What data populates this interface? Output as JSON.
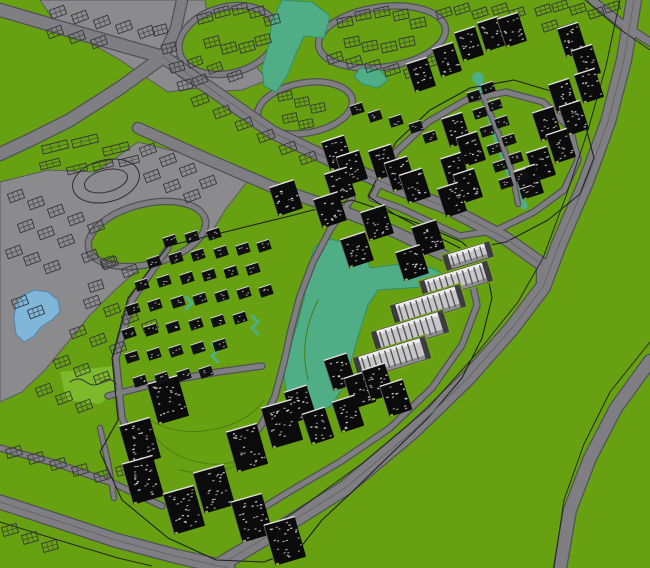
{
  "canvas": {
    "width": 650,
    "height": 568
  },
  "palette": {
    "grass": "#67a112",
    "grass_light": "#7cb92b",
    "paved": "#8b8b8e",
    "road": "#7f7f83",
    "road_casing": "#525256",
    "road_centerline": "#66666a",
    "outline_dark": "#1f1f22",
    "wireframe": "#35353a",
    "water_lake": "#4fae85",
    "water_lake_edge": "#2e8e67",
    "water_pond": "#7fb6d9",
    "water_pond_edge": "#4e86ad",
    "building_dark": "#0b0b0b",
    "building_window": "#d8d8d8",
    "building_cap": "#e0e0e0",
    "slab_body": "#c7c7c9",
    "slab_stripe": "#55555a",
    "slab_top": "#ececec",
    "slab_end": "#3d3d40",
    "landscape_line": "#4c7c10"
  },
  "scene": {
    "areas": [
      {
        "name": "paved-northwest-corridor",
        "pts": "40,0 205,0 212,45 198,88 168,92 120,60 55,22"
      },
      {
        "name": "paved-north-center-patch",
        "pts": "168,56 250,60 268,80 242,90 205,92 178,76"
      },
      {
        "name": "paved-west-district",
        "pts": "0,182 48,170 96,172 138,142 178,152 218,164 250,178 225,210 210,235 168,248 140,268 115,290 90,315 68,342 45,370 22,392 0,402"
      }
    ],
    "patches": [
      {
        "name": "park-lawn-patch",
        "pts": "60,372 112,366 120,390 100,404 66,400"
      }
    ],
    "rings": [
      {
        "name": "loop-road-a",
        "cx": 228,
        "cy": 40,
        "rx": 50,
        "ry": 33,
        "rot": -15,
        "w": 5
      },
      {
        "name": "loop-road-b",
        "cx": 382,
        "cy": 37,
        "rx": 64,
        "ry": 30,
        "rot": -8,
        "w": 5
      },
      {
        "name": "loop-road-c",
        "cx": 305,
        "cy": 108,
        "rx": 48,
        "ry": 25,
        "rot": -10,
        "w": 5
      },
      {
        "name": "loop-road-d",
        "cx": 147,
        "cy": 234,
        "rx": 60,
        "ry": 30,
        "rot": -14,
        "w": 5
      }
    ],
    "water": [
      {
        "name": "west-pond",
        "kind": "pond",
        "pts": "22,296 34,290 48,292 58,300 60,312 52,320 42,326 34,336 24,342 16,334 14,318 16,304"
      },
      {
        "name": "north-pond",
        "kind": "lake",
        "pts": "282,0 312,2 330,16 324,38 304,36 295,56 287,76 276,92 264,86 262,68 269,44 272,20"
      },
      {
        "name": "north-pond-east",
        "kind": "lake",
        "pts": "360,68 380,70 388,80 378,88 362,84 354,76"
      },
      {
        "name": "central-lake",
        "kind": "lake",
        "pts": "325,238 352,244 366,256 370,268 402,264 432,268 447,276 436,286 408,288 378,290 368,305 360,330 352,358 344,385 332,405 315,416 297,410 286,395 284,372 290,348 298,322 305,295 308,268 314,248"
      },
      {
        "name": "northeast-stream",
        "kind": "stream",
        "w": 7,
        "pts": "479,82 486,102 492,122 498,142 505,160 511,177 518,194 524,206"
      },
      {
        "name": "villa-brook-1",
        "kind": "stream",
        "w": 3,
        "pts": "252,316 258,322 252,328 258,334"
      },
      {
        "name": "villa-brook-2",
        "kind": "stream",
        "w": 3,
        "pts": "212,344 218,350 212,356 218,362"
      },
      {
        "name": "villa-brook-3",
        "kind": "stream",
        "w": 3,
        "pts": "186,297 192,303 186,309"
      }
    ],
    "roads": [
      {
        "name": "loop-road-ne-district",
        "w": 5,
        "pts": "372,198 396,152 428,122 466,100 506,92 543,102 570,128 578,160 564,190 534,212 497,230 460,236 430,222 400,208 372,198"
      },
      {
        "name": "ne-district-spine",
        "w": 4,
        "pts": "484,98 498,132 512,172 518,204"
      },
      {
        "name": "villas-west-road",
        "w": 5,
        "pts": "168,248 132,300 116,358 122,418 140,462"
      },
      {
        "name": "lakeshore-road",
        "w": 5,
        "pts": "352,198 330,230 313,262 300,296 291,330 284,362 275,396 262,424 247,444"
      },
      {
        "name": "villas-south-road",
        "w": 5,
        "pts": "108,396 162,382 218,372 262,366"
      },
      {
        "name": "slabs-service-road",
        "w": 5,
        "pts": "470,272 477,305 462,345 432,388 390,428 340,462 292,490 256,512"
      },
      {
        "name": "southwest-minor-road",
        "w": 5,
        "pts": "0,448 58,464 115,484 162,506"
      },
      {
        "name": "southwest-link-road",
        "w": 4,
        "pts": "100,428 108,462 114,498"
      },
      {
        "name": "corner-road-ne",
        "w": 7,
        "pts": "592,0 622,24 650,42"
      },
      {
        "name": "arterial-nw-west",
        "w": 12,
        "pts": "0,10 55,26 110,42 163,57"
      },
      {
        "name": "arterial-nw-north",
        "w": 10,
        "pts": "163,57 176,28 182,0"
      },
      {
        "name": "arterial-sw-branch",
        "w": 12,
        "pts": "163,57 120,88 70,120 30,140 0,154"
      },
      {
        "name": "central-boulevard-north",
        "w": 12,
        "pts": "163,57 215,92 272,132 335,162 392,186 448,208 505,238 543,265 543,287"
      },
      {
        "name": "central-boulevard-south",
        "w": 10,
        "pts": "138,128 205,158 270,186 335,208 395,232 445,256 468,272"
      },
      {
        "name": "ring-expressway",
        "w": 14,
        "pts": "634,0 624,60 608,122 586,182 560,242 543,287 512,328 468,378 412,432 345,488 275,532 228,560 215,568"
      },
      {
        "name": "southeast-curve-road",
        "w": 12,
        "pts": "650,361 616,408 590,458 570,510 560,568"
      },
      {
        "name": "southwest-arc-road",
        "w": 13,
        "pts": "0,502 55,520 115,540 175,556 228,568"
      }
    ],
    "strokes": [
      {
        "name": "parcel-outline-central",
        "color": "#1f1f22",
        "w": 1.1,
        "close": true,
        "pts": "352,200 290,216 225,232 168,246 128,298 112,358 118,420 100,452 122,500 168,538 216,560 264,562 300,548 322,520 352,492 390,455 428,418 462,378 482,338 492,298 486,266 462,242 425,226 388,212"
      },
      {
        "name": "parcel-outline-northeast",
        "color": "#1f1f22",
        "w": 1.1,
        "close": true,
        "pts": "368,196 396,142 430,110 470,88 514,80 554,92 584,120 594,158 580,194 548,220 506,242 464,250 428,232 394,214"
      },
      {
        "name": "boundary-line-expressway",
        "color": "#26262a",
        "w": 1,
        "pts": "620,0 606,66 588,130 566,196 543,258 518,302 478,352 428,408 364,462 298,510 252,540"
      },
      {
        "name": "boundary-line-se-curve",
        "color": "#26262a",
        "w": 1,
        "pts": "650,342 610,392 584,444 564,500 554,568"
      },
      {
        "name": "boundary-line-ne-corner",
        "color": "#26262a",
        "w": 1,
        "pts": "585,0 618,28 650,50"
      },
      {
        "name": "boundary-line-sw-arc",
        "color": "#26262a",
        "w": 1,
        "pts": "0,522 58,540 118,558 152,566"
      },
      {
        "name": "centerline-expressway",
        "color": "#66666a",
        "w": 1,
        "pts": "634,0 624,60 608,122 586,182 560,242 543,287 512,328 468,378 412,432 345,488 275,532 228,560"
      },
      {
        "name": "centerline-boulevard",
        "color": "#66666a",
        "w": 1,
        "pts": "163,57 215,92 272,132 335,162 392,186 448,208 505,238 543,265"
      },
      {
        "name": "centerline-sw-arc",
        "color": "#66666a",
        "w": 1,
        "pts": "0,502 55,520 115,540 175,556 228,568"
      },
      {
        "name": "stadium-track-outer",
        "color": "#2f2f33",
        "w": 1,
        "ellipse": [
          106,
          181,
          34,
          21,
          -14
        ]
      },
      {
        "name": "stadium-track-inner",
        "color": "#2f2f33",
        "w": 1,
        "ellipse": [
          106,
          181,
          22,
          11,
          -14
        ]
      },
      {
        "name": "park-path-squiggle",
        "color": "#2f2f33",
        "w": 1,
        "d": "M 70,382 q 8,-6 16,0 q 8,6 16,0 q 8,-6 14,2"
      },
      {
        "name": "landscape-curve-1",
        "color": "#4c7c10",
        "w": 1,
        "d": "M 150,420 q 30,18 70,8 q 30,-8 44,-28"
      },
      {
        "name": "landscape-curve-2",
        "color": "#4c7c10",
        "w": 1,
        "d": "M 180,470 q 40,10 70,-14"
      },
      {
        "name": "landscape-curve-3",
        "color": "#4c7c10",
        "w": 1,
        "d": "M 318,300 q -20,40 -10,80"
      },
      {
        "name": "landscape-curve-4",
        "color": "#4c7c10",
        "w": 1,
        "d": "M 150,430 q 20,30 60,34 q 30,2 50,-16"
      }
    ],
    "buildings": {
      "towers": [
        {
          "name": "towers-northeast",
          "w": 22,
          "h": 30,
          "rot": -18,
          "items": "421,75 447,60 469,44 492,34 512,30 572,40 586,62 589,86 563,96 574,118 547,124 561,146 541,164 529,182 456,130 471,149 455,170 468,186 452,200"
        },
        {
          "name": "towers-midblock",
          "w": 24,
          "h": 30,
          "rot": -18,
          "items": "337,153 352,168 340,185 384,162 400,174 415,186"
        },
        {
          "name": "towers-central-north",
          "w": 26,
          "h": 30,
          "rot": -18,
          "items": "286,198 330,210 377,223 428,238 357,250 412,263"
        },
        {
          "name": "towers-lake-south",
          "w": 24,
          "h": 32,
          "rot": -18,
          "items": "340,372 360,390 348,414 300,404 318,426 378,382 396,398"
        },
        {
          "name": "towers-southwest",
          "w": 32,
          "h": 42,
          "rot": -16,
          "items": "168,400 140,442 143,480 184,510 214,489 247,448 282,424 252,518 285,541"
        }
      ],
      "villas": [
        {
          "name": "villas-central-grid",
          "w": 13,
          "h": 10,
          "rot": -18,
          "items": "170,241 192,237 214,234 154,262 176,258 198,255 221,252 243,249 264,246 142,285 164,281 187,278 209,275 231,272 253,269 133,309 155,305 178,302 200,299 222,296 244,293 266,291 129,333 151,330 173,327 196,324 218,321 240,318 132,357 154,354 176,351 198,348 220,345 140,381 162,378 184,375 206,372"
        },
        {
          "name": "villas-ne-stream-rows",
          "w": 13,
          "h": 10,
          "rot": -18,
          "items": "488,88 495,105 502,122 509,140 516,158 521,175 527,192 474,96 480,113 487,131 494,149 500,166 506,183 357,109 375,116 396,121 416,127 430,137"
        }
      ],
      "slabs": {
        "name": "slab-blocks-lakeside",
        "rot": -17,
        "items": "456,281,70,20 428,306,72,22 410,332,74,22 392,358,74,22 468,256,48,15"
      },
      "wires": [
        {
          "name": "wireframe-nw-corridor",
          "w": 15,
          "h": 9,
          "rot": -20,
          "items": "58,12 80,17 102,22 124,27 146,32 55,32 77,37 99,42"
        },
        {
          "name": "wireframe-loop-a",
          "w": 15,
          "h": 9,
          "rot": -15,
          "items": "205,18 222,12 240,9 257,12 272,20 212,42 229,48 247,47 263,40"
        },
        {
          "name": "wireframe-west-of-a",
          "w": 14,
          "h": 9,
          "rot": -15,
          "items": "160,30 169,48 177,67 185,85"
        },
        {
          "name": "wireframe-loop-b",
          "w": 15,
          "h": 9,
          "rot": -12,
          "items": "345,22 363,15 382,12 401,15 418,23 352,42 370,46 389,47 407,42"
        },
        {
          "name": "wireframe-north-rows",
          "w": 15,
          "h": 8,
          "rot": -18,
          "items": "444,13 462,9 480,13 500,9 517,13 543,10 560,6 578,9 596,13 612,7 550,26 568,29"
        },
        {
          "name": "wireframe-below-b",
          "w": 15,
          "h": 9,
          "rot": -18,
          "items": "335,58 354,62 373,66 392,70 412,72 430,62 448,56"
        },
        {
          "name": "wireframe-north-patch",
          "w": 14,
          "h": 8,
          "rot": -20,
          "items": "195,62 215,68 235,76 200,80"
        },
        {
          "name": "wireframe-loop-c",
          "w": 14,
          "h": 8,
          "rot": -12,
          "items": "285,96 302,102 318,108 290,118 306,124"
        },
        {
          "name": "wireframe-boulevard-band",
          "w": 16,
          "h": 9,
          "rot": -20,
          "items": "200,100 222,112 244,124 266,136 288,148 308,158"
        },
        {
          "name": "wireframe-district-top",
          "w": 15,
          "h": 9,
          "rot": -20,
          "items": "148,150 168,160 188,170 208,182 152,176 172,186 192,196"
        },
        {
          "name": "wireframe-district-left",
          "w": 15,
          "h": 9,
          "rot": -20,
          "items": "16,196 36,203 56,211 76,219 96,227 26,226 46,233 66,241 14,252 32,259 52,267 90,256 110,263 130,271"
        },
        {
          "name": "wireframe-district-south",
          "w": 15,
          "h": 9,
          "rot": -20,
          "items": "92,302 112,310 130,318 150,326 78,332 98,340 118,348 62,362 82,370 102,378 44,390 64,398 84,406 20,302 36,312"
        },
        {
          "name": "wireframe-sw-green-rows",
          "w": 15,
          "h": 9,
          "rot": -16,
          "items": "14,452 36,458 58,464 80,470 102,476 124,470 146,476"
        },
        {
          "name": "wireframe-sw-corner",
          "w": 15,
          "h": 9,
          "rot": -16,
          "items": "10,530 30,538 50,546"
        },
        {
          "name": "wireframe-left-green",
          "w": 14,
          "h": 9,
          "rot": -18,
          "items": "108,262 96,286"
        },
        {
          "name": "wireframe-stadium-bars",
          "w": 26,
          "h": 8,
          "rot": -14,
          "items": "55,147 85,141 116,149"
        },
        {
          "name": "wireframe-stadium-bars-2",
          "w": 20,
          "h": 7,
          "rot": -14,
          "items": "50,164 77,169 103,165 129,161"
        }
      ]
    }
  }
}
